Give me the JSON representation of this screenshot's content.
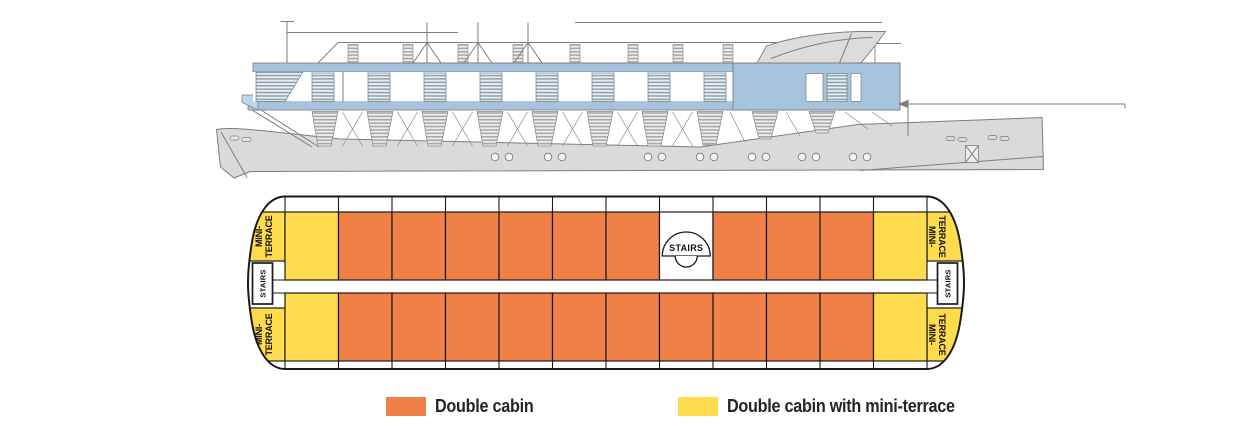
{
  "deck_plan": {
    "labels": {
      "stairs": "STAIRS",
      "mini_terrace_line1": "MINI-",
      "mini_terrace_line2": "TERRACE"
    },
    "colors": {
      "double": "#EE8048",
      "terrace": "#FFDC4D",
      "stairs_open": "#FFFFFF",
      "outline": "#1A1A1A"
    },
    "rows": [
      {
        "id": "front",
        "cells": [
          "terrace",
          "double",
          "double",
          "double",
          "double",
          "double",
          "double",
          "stairs_open",
          "double",
          "double",
          "double",
          "terrace"
        ]
      },
      {
        "id": "back",
        "cells": [
          "terrace",
          "double",
          "double",
          "double",
          "double",
          "double",
          "double",
          "double",
          "double",
          "double",
          "double",
          "terrace"
        ]
      }
    ]
  },
  "legend": {
    "items": [
      {
        "key": "double",
        "label": "Double cabin",
        "color": "#EE8048"
      },
      {
        "key": "terrace",
        "label": "Double cabin with mini-terrace",
        "color": "#FFDC4D"
      }
    ]
  }
}
